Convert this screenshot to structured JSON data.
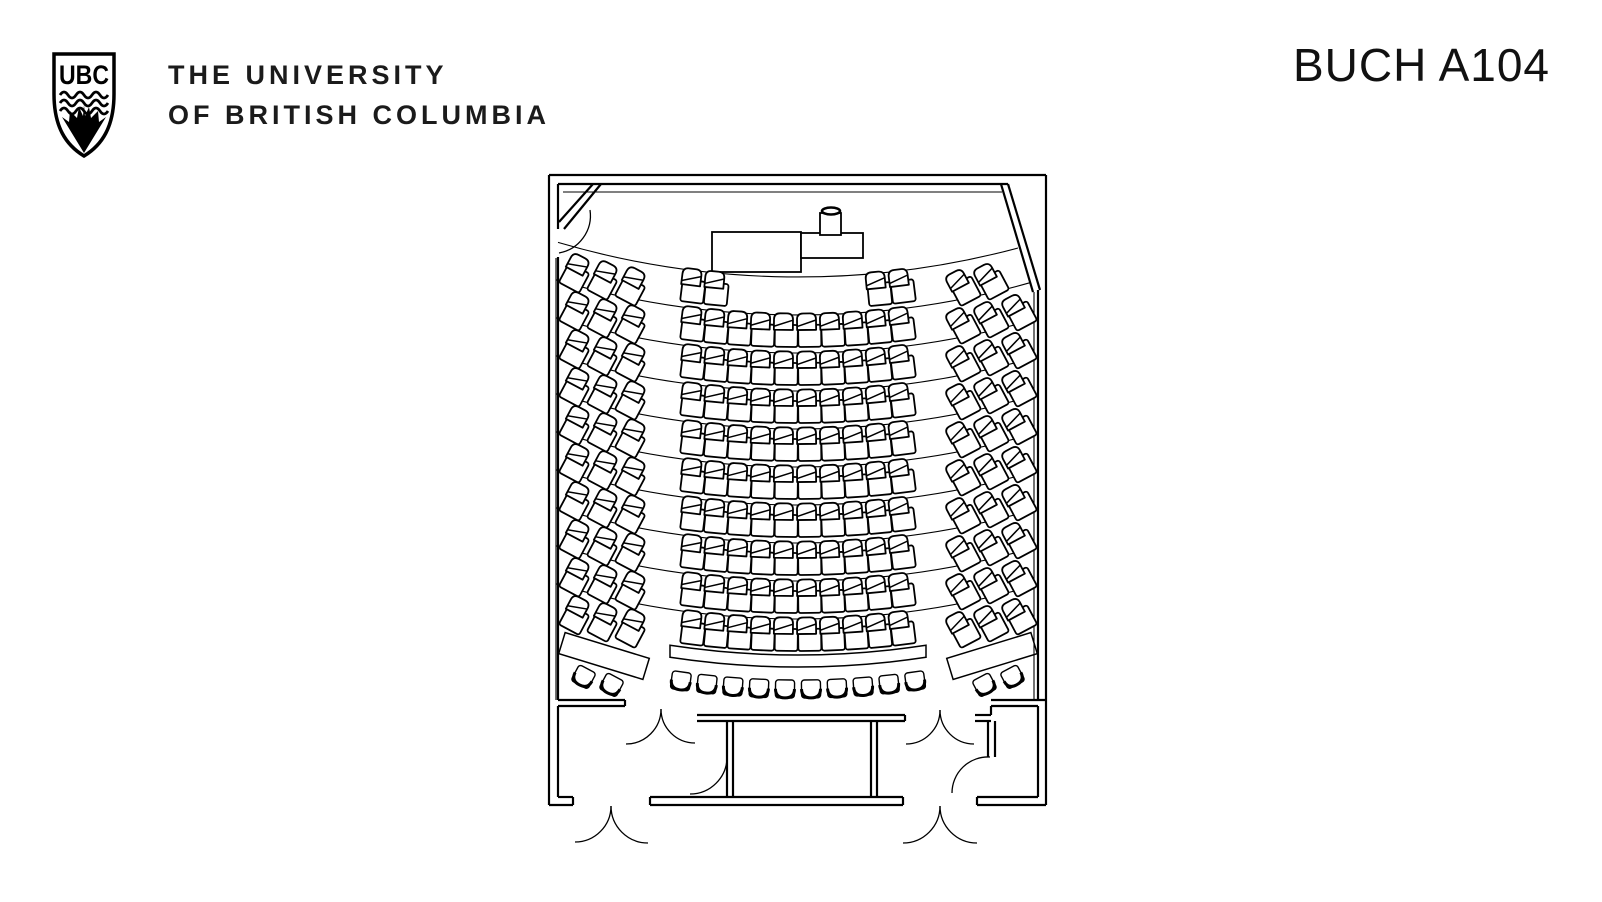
{
  "header": {
    "logo": {
      "initials": "UBC"
    },
    "wordmark_line1": "THE UNIVERSITY",
    "wordmark_line2": "OF BRITISH COLUMBIA",
    "room_title": "BUCH A104"
  },
  "floorplan": {
    "description": "Lecture theatre seating floor plan",
    "ink": "#000000",
    "paper": "#ffffff",
    "seating": {
      "arc_center_x": 798,
      "arc_radius": 850,
      "rows": 10,
      "row_first_center_y": 296,
      "row_pitch": 38,
      "center_seat_offsets": [
        -104.9,
        -81.6,
        -58.3,
        -35,
        -11.7,
        11.7,
        35,
        58.3,
        81.6,
        104.9
      ],
      "front_row_center_seats": [
        0,
        1,
        8,
        9
      ],
      "left_bank_offsets": [
        -223,
        -195,
        -167
      ],
      "right_bank_offsets": [
        167,
        195,
        223
      ],
      "front_row_right_bank_seats": [
        0,
        1
      ],
      "side_seat_rotation_deg": 28,
      "side_bank_y_offset": 10,
      "divider_default_span": [
        556,
        1034
      ],
      "dividers": [
        {
          "y": 277,
          "x1": 558,
          "x2": 1018
        },
        {
          "y": 315,
          "x1": 556,
          "x2": 1030
        },
        {
          "y": 353
        },
        {
          "y": 391
        },
        {
          "y": 429
        },
        {
          "y": 467
        },
        {
          "y": 505
        },
        {
          "y": 543
        },
        {
          "y": 581
        },
        {
          "y": 619
        }
      ],
      "back_counter": {
        "arc_ys": [
          655,
          667
        ],
        "span": [
          -128,
          128
        ],
        "band_w": 88,
        "band_h": 22,
        "side_bands": [
          {
            "cx": 604,
            "cy": 656,
            "rot": 17
          },
          {
            "cx": 992,
            "cy": 656,
            "rot": -17
          }
        ]
      },
      "back_chairs": {
        "arc_y": 688,
        "offsets": [
          -117,
          -91,
          -65,
          -39,
          -13,
          13,
          39,
          65,
          91,
          117
        ]
      },
      "side_back_chairs": [
        {
          "x": 584,
          "y": 676,
          "rot": 28
        },
        {
          "x": 612,
          "y": 684,
          "rot": 28
        },
        {
          "x": 1012,
          "y": 676,
          "rot": -28
        },
        {
          "x": 984,
          "y": 684,
          "rot": -28
        }
      ]
    },
    "teaching_station": {
      "desk_main": [
        712,
        232,
        89,
        40
      ],
      "desk_side": [
        801,
        233,
        62,
        25
      ],
      "podium": [
        820,
        213,
        21,
        22
      ],
      "podium_top": [
        831,
        211,
        9,
        3.5
      ]
    },
    "walls": {
      "thick": [
        "M549 175 H1046",
        "M549 175 V805",
        "M1046 175 V805",
        "M549 805 H573",
        "M650 805 H903",
        "M977 805 H1046",
        "M558 797 H573",
        "M650 797 H903",
        "M977 797 H1038",
        "M558 700 H625",
        "M558 706 H625",
        "M991 700 H1046",
        "M991 706 H1038",
        "M697 715 H905",
        "M697 721 H905",
        "M975 715 H991",
        "M975 721 H991",
        "M727 721 V797",
        "M733 721 V797",
        "M871 721 V797",
        "M877 721 V797",
        "M988 721 V757",
        "M995 721 V757",
        "M558 184 V229",
        "M558 257 V700",
        "M558 706 V797",
        "M558 184 H1008",
        "M1038 290 V700",
        "M1038 706 V797",
        "M593 184 L559 222",
        "M601 184 L564 229",
        "M1001 184 L1033 292",
        "M1008 184 L1040 290",
        "M573 797 V805",
        "M650 797 V805",
        "M903 797 V805",
        "M977 797 V805",
        "M625 700 V706",
        "M905 715 V721",
        "M991 706 V715"
      ],
      "thin": [
        "M563 192 H1002",
        "M556 258 V700",
        "M1034 292 V700"
      ]
    },
    "door_arcs": [
      "M590 210 A38 38 0 0 1 559 253",
      "M661 709 A35 35 0 0 1 626 744",
      "M661 709 A34 34 0 0 0 695 743",
      "M940 710 A34 34 0 0 1 906 744",
      "M940 710 A34 34 0 0 0 974 744",
      "M611 806 A36 36 0 0 1 575 842",
      "M611 806 A37 37 0 0 0 648 843",
      "M940 806 A37 37 0 0 1 903 843",
      "M940 806 A37 37 0 0 0 977 843",
      "M727 757 A37 37 0 0 1 690 794",
      "M990 757 A36 36 0 0 0 952 793"
    ]
  }
}
